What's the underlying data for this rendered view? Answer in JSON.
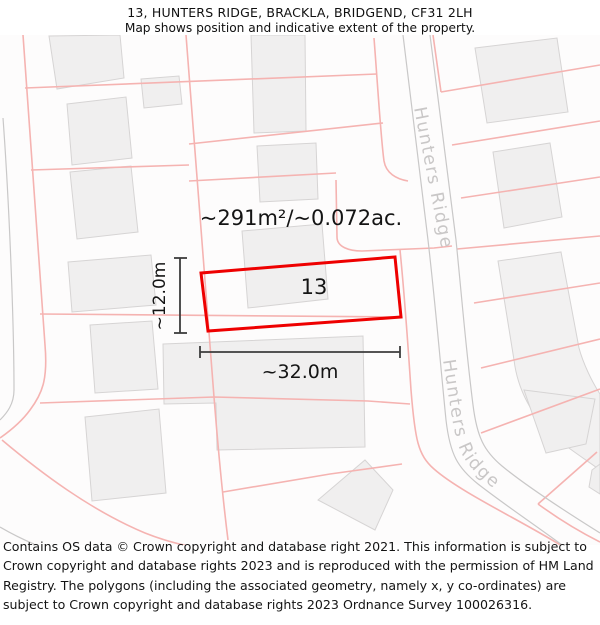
{
  "header": {
    "title": "13, HUNTERS RIDGE, BRACKLA, BRIDGEND, CF31 2LH",
    "subtitle": "Map shows position and indicative extent of the property."
  },
  "map": {
    "area_label": "~291m²/~0.072ac.",
    "plot_number": "13",
    "width_dimension": "~32.0m",
    "height_dimension": "~12.0m",
    "road_name_upper": "Hunters Ridge",
    "road_name_lower": "Hunters Ridge",
    "colors": {
      "property_outline": "#ee0000",
      "parcel_line": "#f5b3b1",
      "road_edge": "#c9c8c8",
      "building_fill": "#f0efef",
      "building_stroke": "#d6d4d4",
      "road_label_text": "#c9c7c7",
      "dimension_line": "#3d3d3d"
    }
  },
  "footer": {
    "copyright": "Contains OS data © Crown copyright and database right 2021. This information is subject to Crown copyright and database rights 2023 and is reproduced with the permission of HM Land Registry. The polygons (including the associated geometry, namely x, y co-ordinates) are subject to Crown copyright and database rights 2023 Ordnance Survey 100026316."
  }
}
